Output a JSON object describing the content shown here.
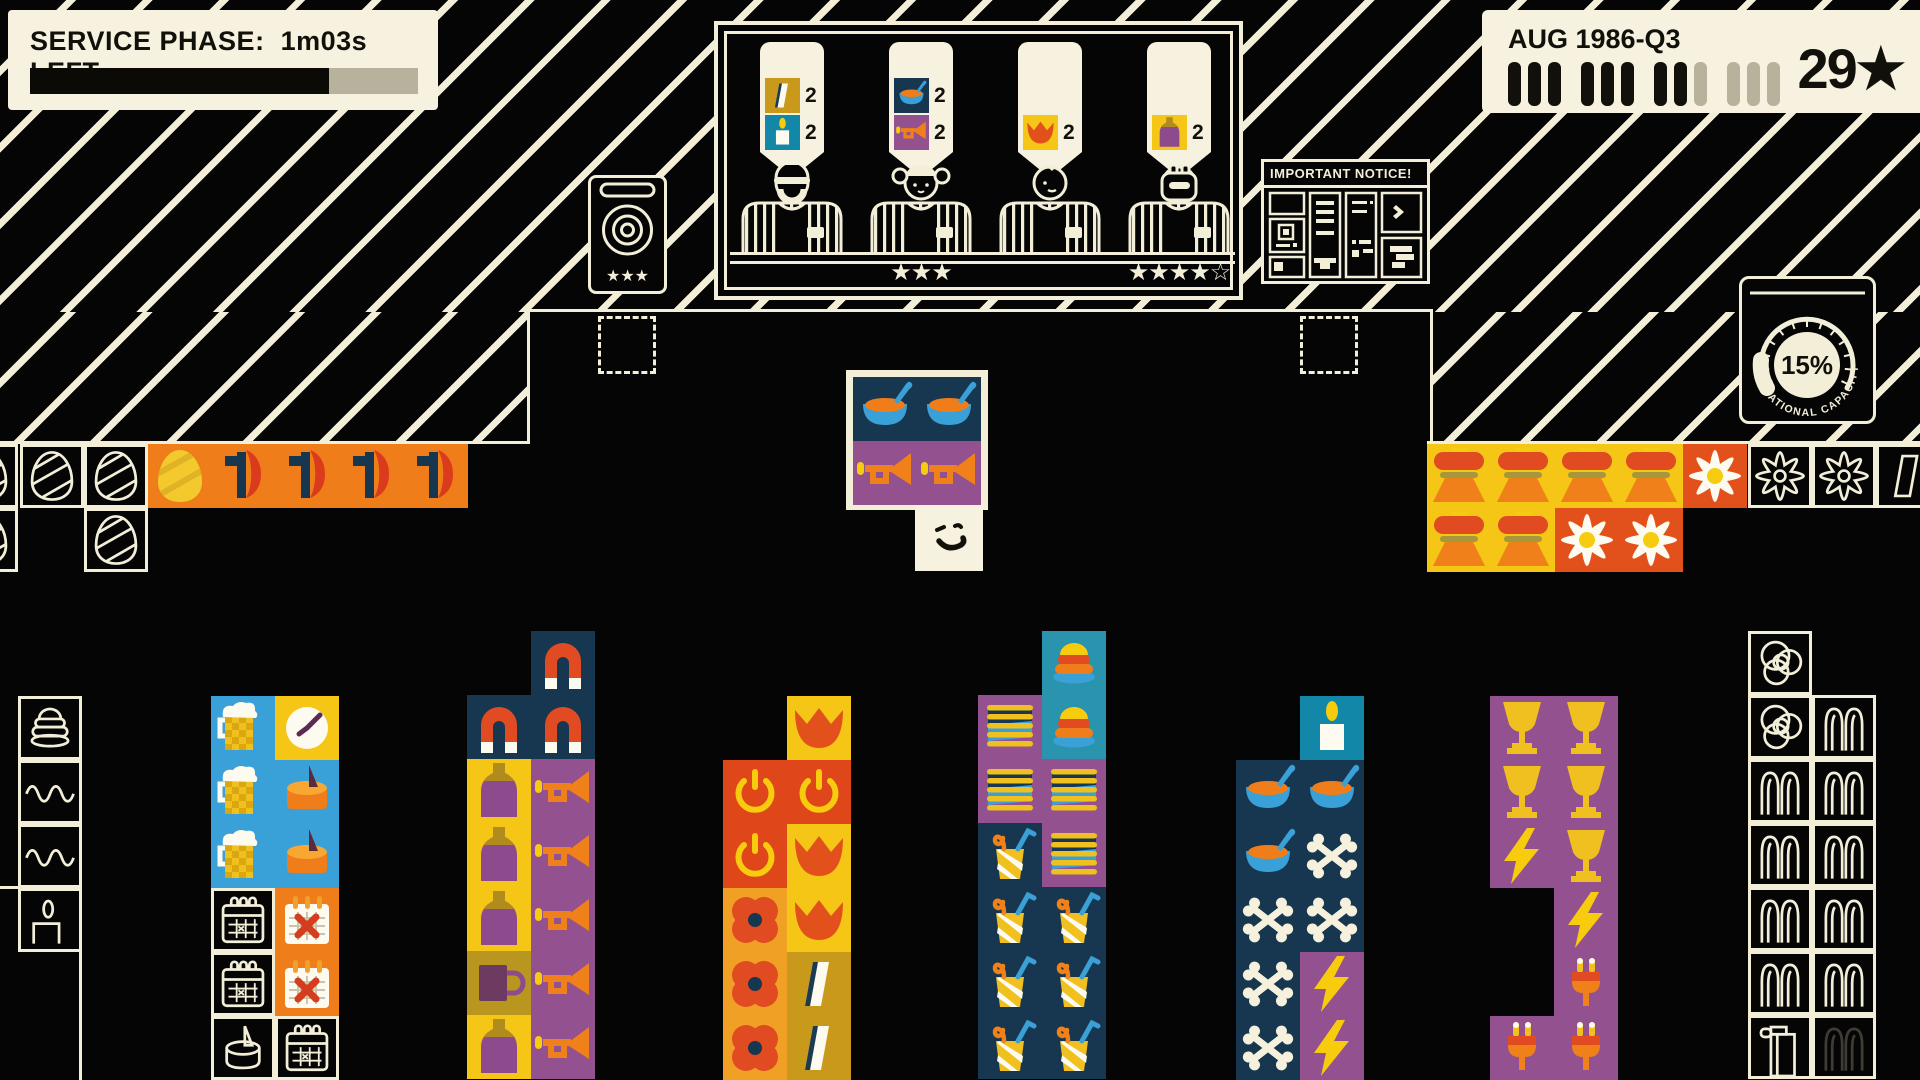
{
  "hud": {
    "service_phase": {
      "label": "SERVICE PHASE:",
      "time_left": "1m03s LEFT",
      "progress_pct": 77
    },
    "date": {
      "label": "AUG 1986-Q3",
      "months_filled": 8,
      "months_total": 12
    },
    "score": {
      "value": "29",
      "star": "★"
    },
    "notice": {
      "title": "IMPORTANT NOTICE!"
    },
    "gauge": {
      "percent": "15%",
      "label": "OPERATIONAL CAPACITY"
    }
  },
  "counter": {
    "customers": [
      {
        "variant": "grandpa",
        "stars": 0,
        "stars_outline": 0,
        "requests": [
          {
            "item": "cheese",
            "qty": "2"
          },
          {
            "item": "candle",
            "qty": "2"
          }
        ]
      },
      {
        "variant": "woman",
        "stars": 3,
        "stars_outline": 0,
        "requests": [
          {
            "item": "soup",
            "qty": "2"
          },
          {
            "item": "trumpet",
            "qty": "2"
          }
        ]
      },
      {
        "variant": "man",
        "stars": 0,
        "stars_outline": 0,
        "requests": [
          {
            "item": "tulip",
            "qty": "2"
          }
        ]
      },
      {
        "variant": "robot",
        "stars": 4,
        "stars_outline": 1,
        "requests": [
          {
            "item": "bottle",
            "qty": "2"
          }
        ]
      }
    ]
  },
  "speaker": {
    "stars": 3
  },
  "player": {
    "held_block": [
      [
        "soup",
        "soup"
      ],
      [
        "trumpet",
        "trumpet"
      ]
    ]
  },
  "drop_targets": [
    [
      598,
      316
    ],
    [
      1300,
      316
    ]
  ],
  "tile_styles": {
    "egg-outline": {
      "outline": true
    },
    "egg": {
      "bg": "#ef7d1a"
    },
    "axe": {
      "bg": "#ef7d1a"
    },
    "table": {
      "bg": "#f5c616"
    },
    "daisy": {
      "bg": "#e2511c"
    },
    "daisy-outline": {
      "outline": true
    },
    "cheese": {
      "bg": "#c9991b"
    },
    "cheese-outline": {
      "outline": true
    },
    "candle": {
      "bg": "#1287a8"
    },
    "candle-outline": {
      "outline": true
    },
    "soup": {
      "bg": "#16374f"
    },
    "trumpet": {
      "bg": "#94518f"
    },
    "tulip": {
      "bg": "#f5c616"
    },
    "bottle": {
      "bg": "#f5c616"
    },
    "beer": {
      "bg": "#3aa0d8"
    },
    "clock": {
      "bg": "#f5c616"
    },
    "sundial": {
      "bg": "#3aa0d8"
    },
    "sundial-outline": {
      "outline": true
    },
    "cal-outline": {
      "outline": true
    },
    "cal-red": {
      "bg": "#ef7d1a"
    },
    "magnet": {
      "bg": "#16374f"
    },
    "power": {
      "bg": "#df4619"
    },
    "poppy": {
      "bg": "#f0a125"
    },
    "pasta": {
      "bg": "#94518f"
    },
    "pasta-outline": {
      "outline": true
    },
    "drink": {
      "bg": "#16374f"
    },
    "burger": {
      "bg": "#2a93ae"
    },
    "burger-outline": {
      "outline": true
    },
    "bones": {
      "bg": "#16374f"
    },
    "lightning": {
      "bg": "#94518f"
    },
    "goblet": {
      "bg": "#94518f"
    },
    "plug": {
      "bg": "#94518f"
    },
    "mug": {
      "bg": "#b8961f"
    },
    "loops-outline": {
      "outline": true
    },
    "loops-dim": {
      "outline": true
    },
    "thermos-outline": {
      "outline": true
    },
    "poppy-outline": {
      "outline": true
    }
  },
  "board": {
    "tiles": [
      [
        -46,
        444,
        "egg-outline"
      ],
      [
        20,
        444,
        "egg-outline"
      ],
      [
        84,
        444,
        "egg-outline"
      ],
      [
        148,
        444,
        "egg"
      ],
      [
        212,
        444,
        "axe"
      ],
      [
        276,
        444,
        "axe"
      ],
      [
        340,
        444,
        "axe"
      ],
      [
        404,
        444,
        "axe"
      ],
      [
        -46,
        508,
        "egg-outline"
      ],
      [
        84,
        508,
        "egg-outline"
      ],
      [
        1427,
        444,
        "table"
      ],
      [
        1491,
        444,
        "table"
      ],
      [
        1555,
        444,
        "table"
      ],
      [
        1619,
        444,
        "table"
      ],
      [
        1683,
        444,
        "daisy"
      ],
      [
        1748,
        444,
        "daisy-outline"
      ],
      [
        1812,
        444,
        "daisy-outline"
      ],
      [
        1876,
        444,
        "cheese-outline"
      ],
      [
        1427,
        508,
        "table"
      ],
      [
        1491,
        508,
        "table"
      ],
      [
        1555,
        508,
        "daisy"
      ],
      [
        1619,
        508,
        "daisy"
      ],
      [
        211,
        696,
        "beer"
      ],
      [
        275,
        696,
        "clock"
      ],
      [
        211,
        760,
        "beer"
      ],
      [
        275,
        760,
        "sundial"
      ],
      [
        211,
        824,
        "beer"
      ],
      [
        275,
        824,
        "sundial"
      ],
      [
        211,
        888,
        "cal-outline"
      ],
      [
        275,
        888,
        "cal-red"
      ],
      [
        211,
        952,
        "cal-outline"
      ],
      [
        275,
        952,
        "cal-red"
      ],
      [
        211,
        1016,
        "sundial-outline"
      ],
      [
        275,
        1016,
        "cal-outline"
      ],
      [
        531,
        631,
        "magnet"
      ],
      [
        467,
        695,
        "magnet"
      ],
      [
        531,
        695,
        "magnet"
      ],
      [
        467,
        759,
        "bottle"
      ],
      [
        531,
        759,
        "trumpet"
      ],
      [
        467,
        823,
        "bottle"
      ],
      [
        531,
        823,
        "trumpet"
      ],
      [
        467,
        887,
        "bottle"
      ],
      [
        531,
        887,
        "trumpet"
      ],
      [
        467,
        951,
        "mug"
      ],
      [
        531,
        951,
        "trumpet"
      ],
      [
        467,
        1015,
        "bottle"
      ],
      [
        531,
        1015,
        "trumpet"
      ],
      [
        787,
        696,
        "tulip"
      ],
      [
        723,
        760,
        "power"
      ],
      [
        787,
        760,
        "power"
      ],
      [
        723,
        824,
        "power"
      ],
      [
        787,
        824,
        "tulip"
      ],
      [
        723,
        888,
        "poppy"
      ],
      [
        787,
        888,
        "tulip"
      ],
      [
        723,
        952,
        "poppy"
      ],
      [
        787,
        952,
        "cheese"
      ],
      [
        723,
        1016,
        "poppy"
      ],
      [
        787,
        1016,
        "cheese"
      ],
      [
        1042,
        631,
        "burger"
      ],
      [
        978,
        695,
        "pasta"
      ],
      [
        1042,
        695,
        "burger"
      ],
      [
        978,
        759,
        "pasta"
      ],
      [
        1042,
        759,
        "pasta"
      ],
      [
        978,
        823,
        "drink"
      ],
      [
        1042,
        823,
        "pasta"
      ],
      [
        978,
        887,
        "drink"
      ],
      [
        1042,
        887,
        "drink"
      ],
      [
        978,
        951,
        "drink"
      ],
      [
        1042,
        951,
        "drink"
      ],
      [
        978,
        1015,
        "drink"
      ],
      [
        1042,
        1015,
        "drink"
      ],
      [
        1300,
        696,
        "candle"
      ],
      [
        1236,
        760,
        "soup"
      ],
      [
        1300,
        760,
        "soup"
      ],
      [
        1236,
        824,
        "soup"
      ],
      [
        1300,
        824,
        "bones"
      ],
      [
        1236,
        888,
        "bones"
      ],
      [
        1300,
        888,
        "bones"
      ],
      [
        1236,
        952,
        "bones"
      ],
      [
        1300,
        952,
        "lightning"
      ],
      [
        1236,
        1016,
        "bones"
      ],
      [
        1300,
        1016,
        "lightning"
      ],
      [
        1490,
        696,
        "goblet"
      ],
      [
        1554,
        696,
        "goblet"
      ],
      [
        1490,
        760,
        "goblet"
      ],
      [
        1554,
        760,
        "goblet"
      ],
      [
        1490,
        824,
        "lightning"
      ],
      [
        1554,
        824,
        "goblet"
      ],
      [
        1554,
        888,
        "lightning"
      ],
      [
        1554,
        952,
        "plug"
      ],
      [
        1490,
        1016,
        "plug"
      ],
      [
        1554,
        1016,
        "plug"
      ],
      [
        18,
        696,
        "burger-outline"
      ],
      [
        18,
        760,
        "pasta-outline"
      ],
      [
        18,
        824,
        "pasta-outline"
      ],
      [
        18,
        888,
        "candle-outline"
      ],
      [
        1748,
        631,
        "poppy-outline"
      ],
      [
        1748,
        695,
        "poppy-outline"
      ],
      [
        1812,
        695,
        "loops-outline"
      ],
      [
        1748,
        759,
        "loops-outline"
      ],
      [
        1812,
        759,
        "loops-outline"
      ],
      [
        1748,
        823,
        "loops-outline"
      ],
      [
        1812,
        823,
        "loops-outline"
      ],
      [
        1748,
        887,
        "loops-outline"
      ],
      [
        1812,
        887,
        "loops-outline"
      ],
      [
        1748,
        951,
        "loops-outline"
      ],
      [
        1812,
        951,
        "loops-outline"
      ],
      [
        1748,
        1015,
        "thermos-outline"
      ],
      [
        1812,
        1015,
        "loops-dim"
      ]
    ]
  }
}
